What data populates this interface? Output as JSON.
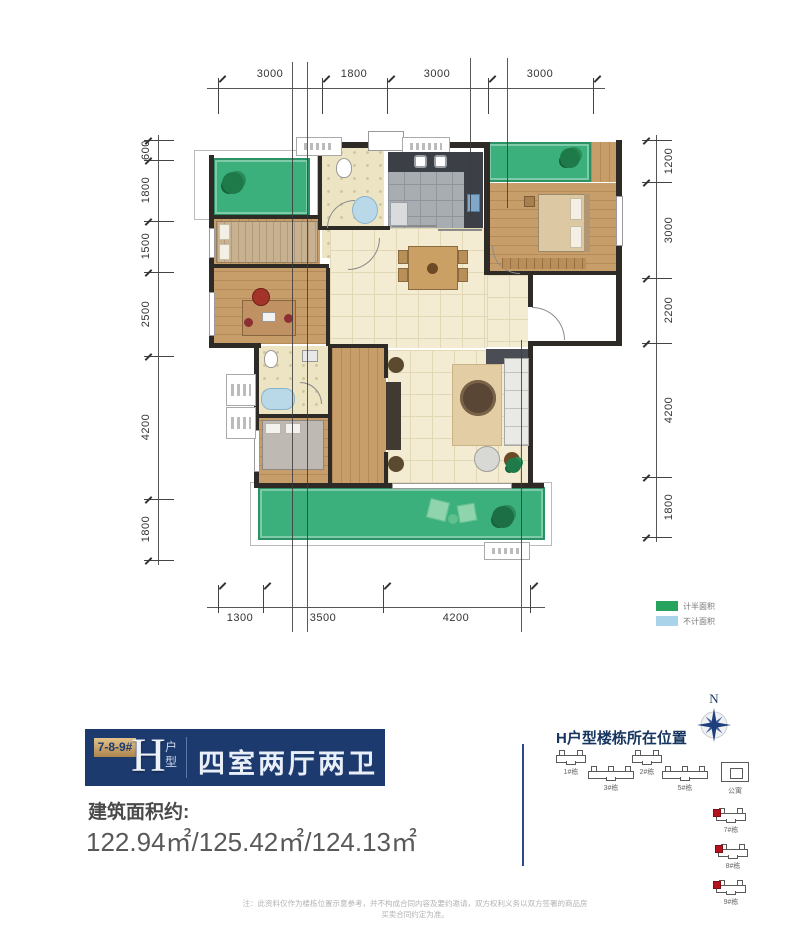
{
  "plan": {
    "dims": {
      "top": [
        "3000",
        "1800",
        "3000",
        "3000"
      ],
      "left": [
        "600",
        "1800",
        "1500",
        "2500",
        "4200",
        "1800"
      ],
      "right": [
        "1200",
        "3000",
        "2200",
        "4200",
        "1800"
      ],
      "bottom": [
        "1300",
        "3500",
        "4200"
      ]
    },
    "legend": [
      {
        "label": "计半面积",
        "color": "#28a35d"
      },
      {
        "label": "不计面积",
        "color": "#a8d3e9"
      }
    ]
  },
  "info": {
    "tag": "7-8-9#",
    "type_letter": "H",
    "type_suffix": "户型",
    "title": "四室两厅两卫",
    "area_label": "建筑面积约:",
    "area_value": "122.94㎡/125.42㎡/124.13㎡"
  },
  "location": {
    "title": "H户型楼栋所在位置",
    "compass_label": "N",
    "buildings": [
      {
        "label": "1#栋",
        "highlight": false
      },
      {
        "label": "3#栋",
        "highlight": false
      },
      {
        "label": "2#栋",
        "highlight": false
      },
      {
        "label": "5#栋",
        "highlight": false
      },
      {
        "label": "公寓",
        "highlight": false
      },
      {
        "label": "7#栋",
        "highlight": true
      },
      {
        "label": "8#栋",
        "highlight": true
      },
      {
        "label": "9#栋",
        "highlight": true
      }
    ]
  },
  "footer": {
    "disclaimer": "注：此资料仅作为楼栋位置示意参考，并不构成合同内容及要约邀请，双方权利义务以双方签署的商品房买卖合同约定为准。"
  },
  "colors": {
    "navy": "#1d3a6e",
    "gold": "#c9a667",
    "balcony_green": "#3bb07c",
    "legend_green": "#28a35d",
    "legend_blue": "#a8d3e9",
    "highlight_red": "#b5121b",
    "wall": "#2e2a25"
  }
}
